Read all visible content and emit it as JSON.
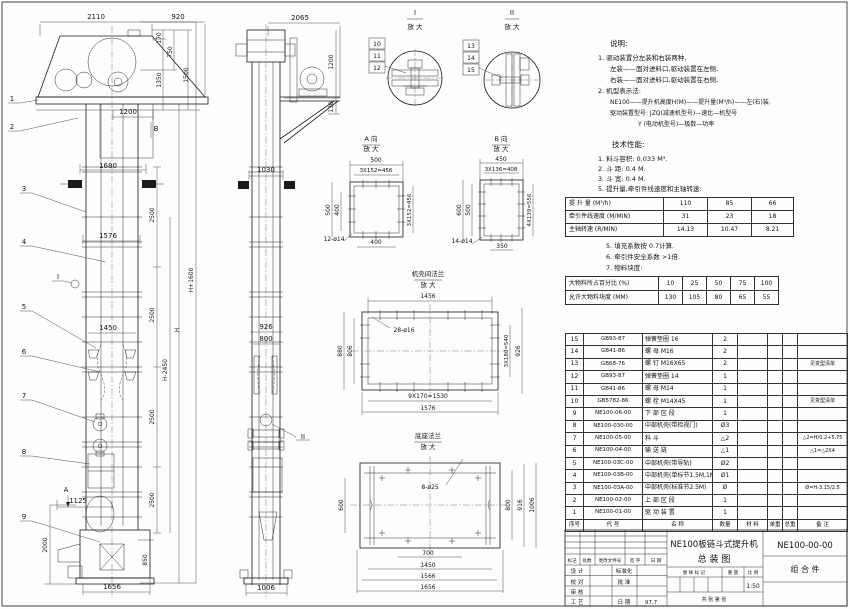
{
  "panel": {
    "speed_table": {
      "rows": [
        {
          "label": "提 升 量  (M³/h)",
          "values": [
            "110",
            "85",
            "66"
          ]
        },
        {
          "label": "牵引件线速度 (M/MIN)",
          "values": [
            "31",
            "23",
            "18"
          ]
        },
        {
          "label": "主轴转速 (R/MIN)",
          "values": [
            "14.13",
            "10.47",
            "8.21"
          ]
        }
      ]
    },
    "lump_table": {
      "rows": [
        {
          "label": "大物料所占百分比 (%)",
          "values": [
            "10",
            "25",
            "50",
            "75",
            "100"
          ]
        },
        {
          "label": "允许大物料块度 (MM)",
          "values": [
            "130",
            "105",
            "80",
            "65",
            "55"
          ]
        }
      ]
    }
  },
  "bom": {
    "headers": [
      "序号",
      "代  号",
      "名  称",
      "数量",
      "材  料",
      "单重",
      "总重",
      "备  注"
    ],
    "rows": [
      [
        "15",
        "GB93-87",
        "弹簧垫圈  16",
        "2",
        "",
        "",
        "",
        ""
      ],
      [
        "14",
        "GB41-86",
        "螺 母  M16",
        "2",
        "",
        "",
        "",
        ""
      ],
      [
        "13",
        "GB68-76",
        "螺 钉  M16X65",
        "2",
        "",
        "",
        "",
        "见变型清单"
      ],
      [
        "12",
        "GB93-87",
        "弹簧垫圈  14",
        "1",
        "",
        "",
        "",
        ""
      ],
      [
        "11",
        "GB41-86",
        "螺 母  M14",
        "1",
        "",
        "",
        "",
        ""
      ],
      [
        "10",
        "GB5782-86",
        "螺 栓  M14X45",
        "1",
        "",
        "",
        "",
        "见变型清单"
      ],
      [
        "9",
        "NE100-06-00",
        "下 部 区 段",
        "1",
        "",
        "",
        "",
        ""
      ],
      [
        "8",
        "NE100-030-00",
        "中部机壳(带检视门)",
        "Ø3",
        "",
        "",
        "",
        ""
      ],
      [
        "7",
        "NE100-05-00",
        "料  斗",
        "△2",
        "",
        "",
        "",
        "△2=H/0.2+5.75"
      ],
      [
        "6",
        "NE100-04-00",
        "输 送 链",
        "△1",
        "",
        "",
        "",
        "△1=△2X4"
      ],
      [
        "5",
        "NE100-03C-00",
        "中部机壳(带导轨)",
        "Ø2",
        "",
        "",
        "",
        ""
      ],
      [
        "4",
        "NE100-03B-00",
        "中部机壳(单标节1.5M,1M)",
        "Ø1",
        "",
        "",
        "",
        ""
      ],
      [
        "3",
        "NE100-03A-00",
        "中部机壳(标准节2.5M)",
        "Ø",
        "",
        "",
        "",
        "Ø=H-3.15/2.5"
      ],
      [
        "2",
        "NE100-02-00",
        "上 部 区 段",
        "1",
        "",
        "",
        "",
        ""
      ],
      [
        "1",
        "NE100-01-00",
        "驱 动 装 置",
        "1",
        "",
        "",
        "",
        ""
      ]
    ]
  },
  "title_block": {
    "title_line1": "NE100板链斗式提升机",
    "title_line2": "总  装  图",
    "drawing_no": "NE100-00-00",
    "part_type": "组 合 件",
    "scale": "1:50",
    "date": "97.7",
    "sheet_label": "共   张   第   张"
  },
  "annotations": [
    {
      "x": 610,
      "y": 46,
      "t": "说明:",
      "a": "s",
      "fs": 7.5
    },
    {
      "x": 598,
      "y": 60,
      "t": "1. 驱动装置分左装和右装两种,",
      "a": "s",
      "fs": 6.5
    },
    {
      "x": 610,
      "y": 71,
      "t": "左装——面对进料口,驱动装置在左侧,",
      "a": "s",
      "fs": 6.5
    },
    {
      "x": 610,
      "y": 82,
      "t": "右装——面对进料口,驱动装置在右侧,",
      "a": "s",
      "fs": 6.5
    },
    {
      "x": 598,
      "y": 93,
      "t": "2. 机型表示法:",
      "a": "s",
      "fs": 6.5
    },
    {
      "x": 610,
      "y": 104,
      "t": "NE100——提升机高度H(M)——提升量(M³/h)——左(右)装.",
      "a": "s",
      "fs": 6
    },
    {
      "x": 610,
      "y": 115,
      "t": "驱动装置型号: JZQ(减速机型号)—速比—机型号",
      "a": "s",
      "fs": 6
    },
    {
      "x": 638,
      "y": 126,
      "t": "Y (电动机型号)—极数—功率",
      "a": "s",
      "fs": 6
    },
    {
      "x": 612,
      "y": 147,
      "t": "技术性能:",
      "a": "s",
      "fs": 7.5
    },
    {
      "x": 598,
      "y": 161,
      "t": "1. 料斗容积: 0.033 M³.",
      "a": "s",
      "fs": 6.5
    },
    {
      "x": 598,
      "y": 171,
      "t": "2. 斗    距: 0.4 M.",
      "a": "s",
      "fs": 6.5
    },
    {
      "x": 598,
      "y": 181,
      "t": "3. 斗    宽: 0.4 M.",
      "a": "s",
      "fs": 6.5
    },
    {
      "x": 598,
      "y": 191,
      "t": "5. 提升量,牵引件线速度和主轴转速:",
      "a": "s",
      "fs": 6.5
    },
    {
      "x": 606,
      "y": 248,
      "t": "5. 填充系数按 0.7计算.",
      "a": "s",
      "fs": 6.5
    },
    {
      "x": 606,
      "y": 259,
      "t": "6. 牵引件安全系数 >1倍.",
      "a": "s",
      "fs": 6.5
    },
    {
      "x": 606,
      "y": 270,
      "t": "7. 物料块度:",
      "a": "s",
      "fs": 6.5
    },
    {
      "x": 96,
      "y": 19,
      "t": "2110"
    },
    {
      "x": 178,
      "y": 19,
      "t": "920"
    },
    {
      "x": 161,
      "y": 38,
      "t": "170",
      "r": 1,
      "fs": 6
    },
    {
      "x": 161,
      "y": 80,
      "t": "1350",
      "r": 1,
      "fs": 6
    },
    {
      "x": 172,
      "y": 52,
      "t": "750",
      "r": 1,
      "fs": 6
    },
    {
      "x": 188,
      "y": 75,
      "t": "1500",
      "r": 1,
      "fs": 6
    },
    {
      "x": 128,
      "y": 114,
      "t": "1200"
    },
    {
      "x": 108,
      "y": 168,
      "t": "1680"
    },
    {
      "x": 108,
      "y": 238,
      "t": "1576"
    },
    {
      "x": 108,
      "y": 330,
      "t": "1450"
    },
    {
      "x": 78,
      "y": 503,
      "t": "1125"
    },
    {
      "x": 112,
      "y": 589,
      "t": "1656"
    },
    {
      "x": 154,
      "y": 215,
      "t": "2500",
      "r": 1,
      "fs": 6
    },
    {
      "x": 154,
      "y": 315,
      "t": "2500",
      "r": 1,
      "fs": 6
    },
    {
      "x": 154,
      "y": 417,
      "t": "2500",
      "r": 1,
      "fs": 6
    },
    {
      "x": 154,
      "y": 500,
      "t": "2500",
      "r": 1,
      "fs": 6
    },
    {
      "x": 167,
      "y": 370,
      "t": "H-2450",
      "r": 1,
      "fs": 6
    },
    {
      "x": 179,
      "y": 330,
      "t": "H",
      "r": 1,
      "fs": 6
    },
    {
      "x": 193,
      "y": 280,
      "t": "H+1600",
      "r": 1,
      "fs": 6
    },
    {
      "x": 47,
      "y": 545,
      "t": "2000",
      "r": 1,
      "fs": 6
    },
    {
      "x": 147,
      "y": 560,
      "t": "850",
      "r": 1,
      "fs": 6
    },
    {
      "x": 156,
      "y": 131,
      "t": "B"
    },
    {
      "x": 66,
      "y": 492,
      "t": "A"
    },
    {
      "x": 58,
      "y": 279,
      "t": "I"
    },
    {
      "x": 12,
      "y": 101,
      "t": "1"
    },
    {
      "x": 12,
      "y": 129,
      "t": "2"
    },
    {
      "x": 24,
      "y": 191,
      "t": "3"
    },
    {
      "x": 24,
      "y": 244,
      "t": "4"
    },
    {
      "x": 24,
      "y": 309,
      "t": "5"
    },
    {
      "x": 24,
      "y": 354,
      "t": "6"
    },
    {
      "x": 24,
      "y": 398,
      "t": "7"
    },
    {
      "x": 24,
      "y": 454,
      "t": "8"
    },
    {
      "x": 24,
      "y": 519,
      "t": "9"
    },
    {
      "x": 300,
      "y": 20,
      "t": "2065"
    },
    {
      "x": 333,
      "y": 62,
      "t": "1200",
      "r": 1,
      "fs": 6
    },
    {
      "x": 333,
      "y": 107,
      "t": "130",
      "r": 1,
      "fs": 6
    },
    {
      "x": 266,
      "y": 172,
      "t": "1030"
    },
    {
      "x": 266,
      "y": 329,
      "t": "926"
    },
    {
      "x": 266,
      "y": 341,
      "t": "800"
    },
    {
      "x": 266,
      "y": 590,
      "t": "1006"
    },
    {
      "x": 303,
      "y": 439,
      "t": "II"
    },
    {
      "x": 415,
      "y": 15,
      "t": "I"
    },
    {
      "x": 415,
      "y": 29,
      "t": "放 大",
      "fs": 6.5
    },
    {
      "x": 377,
      "y": 46,
      "t": "10",
      "b": 1,
      "fs": 6
    },
    {
      "x": 377,
      "y": 58,
      "t": "11",
      "b": 1,
      "fs": 6
    },
    {
      "x": 377,
      "y": 70,
      "t": "12",
      "b": 1,
      "fs": 6
    },
    {
      "x": 512,
      "y": 15,
      "t": "II"
    },
    {
      "x": 512,
      "y": 29,
      "t": "放 大",
      "fs": 6.5
    },
    {
      "x": 471,
      "y": 48,
      "t": "13",
      "b": 1,
      "fs": 6
    },
    {
      "x": 471,
      "y": 60,
      "t": "14",
      "b": 1,
      "fs": 6
    },
    {
      "x": 471,
      "y": 72,
      "t": "15",
      "b": 1,
      "fs": 6
    },
    {
      "x": 371,
      "y": 141,
      "t": "A 向",
      "fs": 6.5
    },
    {
      "x": 371,
      "y": 151,
      "t": "放 大",
      "fs": 6.5
    },
    {
      "x": 376,
      "y": 162,
      "t": "500",
      "fs": 6
    },
    {
      "x": 376,
      "y": 172,
      "t": "3X152=456",
      "fs": 5.5
    },
    {
      "x": 330,
      "y": 210,
      "t": "500",
      "r": 1,
      "fs": 6
    },
    {
      "x": 339,
      "y": 210,
      "t": "400",
      "r": 1,
      "fs": 6
    },
    {
      "x": 411,
      "y": 210,
      "t": "3X152=456",
      "r": 1,
      "fs": 5.5
    },
    {
      "x": 376,
      "y": 244,
      "t": "400",
      "fs": 6
    },
    {
      "x": 334,
      "y": 241,
      "t": "12-ø14",
      "fs": 6
    },
    {
      "x": 501,
      "y": 141,
      "t": "B 向",
      "fs": 6.5
    },
    {
      "x": 501,
      "y": 151,
      "t": "放 大",
      "fs": 6.5
    },
    {
      "x": 501,
      "y": 161,
      "t": "450",
      "fs": 6
    },
    {
      "x": 501,
      "y": 171,
      "t": "3X136=408",
      "fs": 5.5
    },
    {
      "x": 461,
      "y": 210,
      "t": "600",
      "r": 1,
      "fs": 6
    },
    {
      "x": 470,
      "y": 210,
      "t": "500",
      "r": 1,
      "fs": 6
    },
    {
      "x": 531,
      "y": 210,
      "t": "4X139=556",
      "r": 1,
      "fs": 5.5
    },
    {
      "x": 502,
      "y": 248,
      "t": "350",
      "fs": 6
    },
    {
      "x": 462,
      "y": 243,
      "t": "14-ø14",
      "fs": 6
    },
    {
      "x": 428,
      "y": 276,
      "t": "机壳间法兰",
      "fs": 6.5
    },
    {
      "x": 428,
      "y": 287,
      "t": "放 大",
      "fs": 6.5
    },
    {
      "x": 428,
      "y": 298,
      "t": "1456",
      "fs": 6
    },
    {
      "x": 404,
      "y": 332,
      "t": "28-ø16",
      "fs": 6
    },
    {
      "x": 342,
      "y": 351,
      "t": "880",
      "r": 1,
      "fs": 6
    },
    {
      "x": 352,
      "y": 351,
      "t": "806",
      "r": 1,
      "fs": 6
    },
    {
      "x": 508,
      "y": 351,
      "t": "3X180=540",
      "r": 1,
      "fs": 5.5
    },
    {
      "x": 520,
      "y": 351,
      "t": "926",
      "r": 1,
      "fs": 6
    },
    {
      "x": 428,
      "y": 398,
      "t": "9X170=1530",
      "fs": 6
    },
    {
      "x": 428,
      "y": 410,
      "t": "1576",
      "fs": 6
    },
    {
      "x": 428,
      "y": 438,
      "t": "底座法兰",
      "fs": 6.5
    },
    {
      "x": 428,
      "y": 449,
      "t": "放 大",
      "fs": 6.5
    },
    {
      "x": 430,
      "y": 489,
      "t": "8-ø25",
      "fs": 6
    },
    {
      "x": 343,
      "y": 505,
      "t": "600",
      "r": 1,
      "fs": 6
    },
    {
      "x": 510,
      "y": 505,
      "t": "800",
      "r": 1,
      "fs": 6
    },
    {
      "x": 522,
      "y": 505,
      "t": "916",
      "r": 1,
      "fs": 6
    },
    {
      "x": 534,
      "y": 505,
      "t": "1006",
      "r": 1,
      "fs": 6
    },
    {
      "x": 428,
      "y": 555,
      "t": "700",
      "fs": 6
    },
    {
      "x": 428,
      "y": 567,
      "t": "1450",
      "fs": 6
    },
    {
      "x": 428,
      "y": 578,
      "t": "1566",
      "fs": 6
    },
    {
      "x": 428,
      "y": 589,
      "t": "1656",
      "fs": 6
    },
    {
      "x": 572,
      "y": 562,
      "t": "标记",
      "fs": 4.5
    },
    {
      "x": 587,
      "y": 562,
      "t": "处数",
      "fs": 4.5
    },
    {
      "x": 610,
      "y": 562,
      "t": "更改文件号",
      "fs": 4.5
    },
    {
      "x": 635,
      "y": 562,
      "t": "签 字",
      "fs": 4.5
    },
    {
      "x": 656,
      "y": 562,
      "t": "日 期",
      "fs": 4.5
    },
    {
      "x": 577,
      "y": 573,
      "t": "设 计",
      "fs": 5.5
    },
    {
      "x": 624,
      "y": 573,
      "t": "标准化",
      "fs": 5.5
    },
    {
      "x": 577,
      "y": 584,
      "t": "校 对",
      "fs": 5.5
    },
    {
      "x": 624,
      "y": 584,
      "t": "批 准",
      "fs": 5.5
    },
    {
      "x": 577,
      "y": 594,
      "t": "审 核",
      "fs": 5.5
    },
    {
      "x": 577,
      "y": 604,
      "t": "工 艺",
      "fs": 5.5
    },
    {
      "x": 624,
      "y": 604,
      "t": "日 期",
      "fs": 5.5
    },
    {
      "x": 694,
      "y": 574,
      "t": "图 样 标 记",
      "fs": 4.5
    },
    {
      "x": 733,
      "y": 574,
      "t": "重 量",
      "fs": 4.5
    },
    {
      "x": 753,
      "y": 574,
      "t": "比 例",
      "fs": 4.5
    }
  ]
}
